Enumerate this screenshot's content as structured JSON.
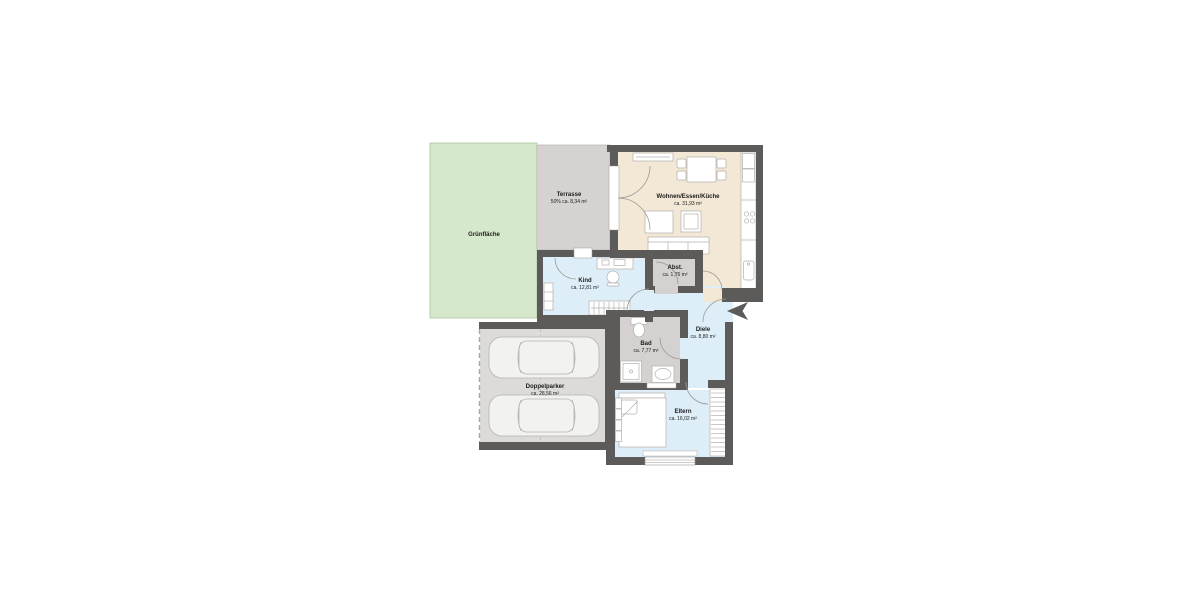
{
  "plan": {
    "type": "floor-plan",
    "language": "de",
    "rooms": [
      {
        "key": "gruenflaeche",
        "name": "Grünfläche",
        "area": ""
      },
      {
        "key": "terrasse",
        "name": "Terrasse",
        "area": "50% ca. 8,34 m²"
      },
      {
        "key": "wohnen",
        "name": "Wohnen/Essen/Küche",
        "area": "ca. 31,93 m²"
      },
      {
        "key": "kind",
        "name": "Kind",
        "area": "ca. 12,81 m²"
      },
      {
        "key": "abst",
        "name": "Abst.",
        "area": "ca. 1,76 m²"
      },
      {
        "key": "diele",
        "name": "Diele",
        "area": "ca. 8,80 m²"
      },
      {
        "key": "bad",
        "name": "Bad",
        "area": "ca. 7,77 m²"
      },
      {
        "key": "doppelparker",
        "name": "Doppelparker",
        "area": "ca. 28,56 m²"
      },
      {
        "key": "eltern",
        "name": "Eltern",
        "area": "ca. 16,02 m²"
      }
    ],
    "colors": {
      "wall": "#5c5b59",
      "green": "#d6e8cb",
      "terrace": "#d6d2d1",
      "living": "#f2e8d5",
      "blue": "#ddeef8",
      "utility": "#d5d1d0",
      "garage": "#dcdbda",
      "car": "#f2f2f1",
      "text": "#1c1c1c",
      "arrow": "#5c5b59"
    },
    "icons": {
      "entrance": "entrance-arrow"
    }
  }
}
